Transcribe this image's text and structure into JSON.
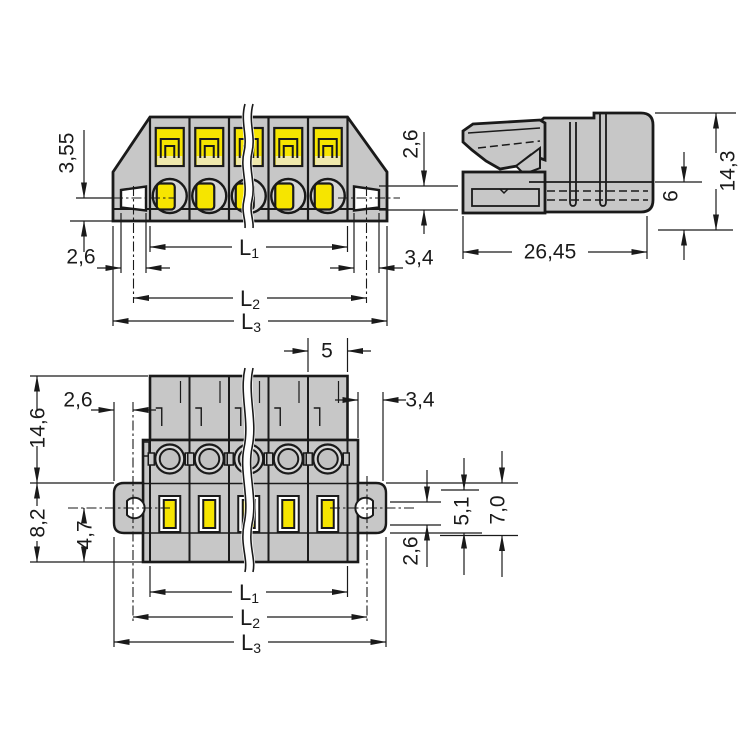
{
  "colors": {
    "housing": "#c7c7c7",
    "contact_yellow": "#f6e500",
    "pale_yellow": "#efe8ac",
    "outline": "#1a1a1a",
    "flange_white": "#ffffff",
    "circle_gray": "#d7d7d7",
    "inner_circle_gray": "#c2c2c2",
    "background": "#ffffff"
  },
  "front_view": {
    "dim_3_55": "3,55",
    "dim_2_6_left": "2,6",
    "dim_2_6_right": "2,6",
    "dim_3_4": "3,4",
    "L1": "L",
    "L1_sub": "1",
    "L2": "L",
    "L2_sub": "2",
    "L3": "L",
    "L3_sub": "3"
  },
  "side_view": {
    "dim_26_45": "26,45",
    "dim_14_3": "14,3",
    "dim_6": "6"
  },
  "bottom_view": {
    "dim_5": "5",
    "dim_2_6_top_left": "2,6",
    "dim_3_4": "3,4",
    "dim_14_6": "14,6",
    "dim_8_2": "8,2",
    "dim_4_7": "4,7",
    "dim_2_6_right": "2,6",
    "dim_5_1": "5,1",
    "dim_7_0": "7,0",
    "L1": "L",
    "L1_sub": "1",
    "L2": "L",
    "L2_sub": "2",
    "L3": "L",
    "L3_sub": "3"
  }
}
